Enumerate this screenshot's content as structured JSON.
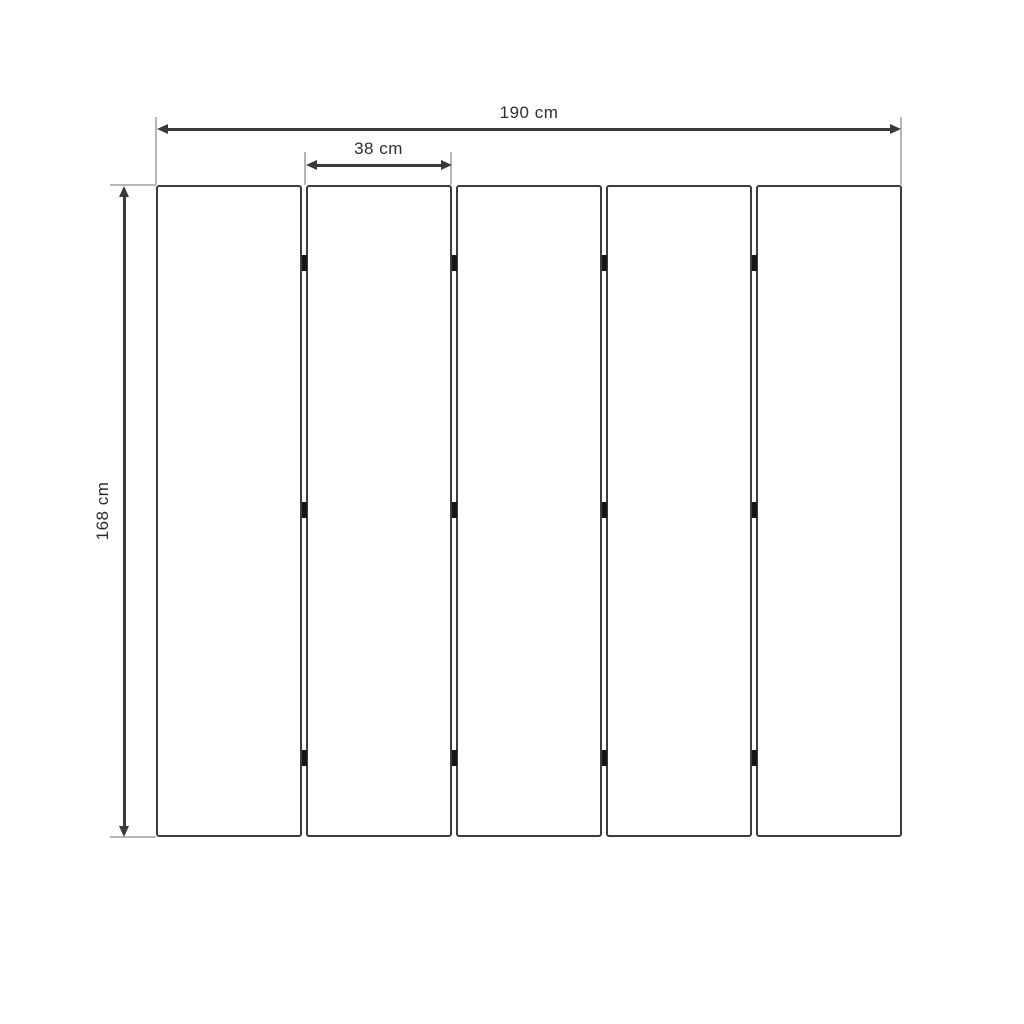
{
  "diagram": {
    "type": "furniture-dimension-drawing",
    "subject": "five-panel folding screen front view",
    "panel_count": 5,
    "hinge_rows": 3,
    "dimensions": {
      "total_width_label": "190 cm",
      "panel_width_label": "38 cm",
      "height_label": "168 cm"
    },
    "colors": {
      "background": "#ffffff",
      "dimension_line": "#3a3a3a",
      "extension_line": "#b6b6b6",
      "panel_border": "#3d3d3d",
      "hinge": "#161616",
      "label_text": "#2e2e2e"
    }
  }
}
